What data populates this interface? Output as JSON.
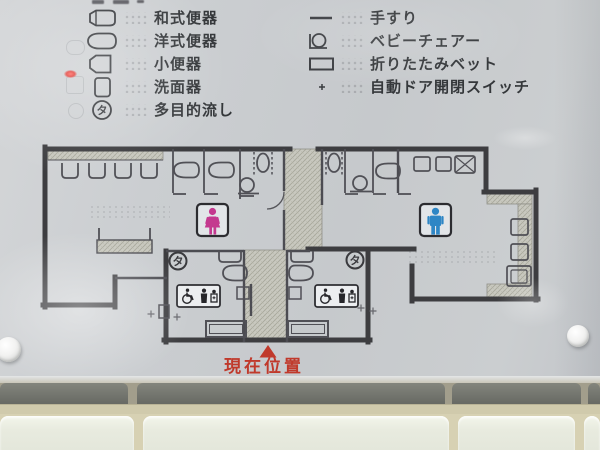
{
  "sign": {
    "legend": {
      "left": [
        {
          "name": "squat-toilet",
          "label": "和式便器"
        },
        {
          "name": "western-toilet",
          "label": "洋式便器"
        },
        {
          "name": "urinal",
          "label": "小便器"
        },
        {
          "name": "washbasin",
          "label": "洗面器"
        },
        {
          "name": "multipurpose-sink",
          "label": "多目的流し",
          "symbol": "タ"
        }
      ],
      "right": [
        {
          "name": "handrail",
          "label": "手すり"
        },
        {
          "name": "baby-chair",
          "label": "ベビーチェアー"
        },
        {
          "name": "folding-bed",
          "label": "折りたたみベット"
        },
        {
          "name": "auto-door-switch",
          "label": "自動ドア開閉スイッチ",
          "symbol": "+"
        }
      ]
    },
    "floor_plan": {
      "ta_symbol": "タ",
      "current_location": "現在位置"
    },
    "colors": {
      "marker_red": "#c0392b",
      "womens_pink": "#c4398f",
      "mens_blue": "#2e86c5",
      "wall": "#3d3d40",
      "panel": "#c9ccd0",
      "tile": "#e9ece1"
    }
  }
}
